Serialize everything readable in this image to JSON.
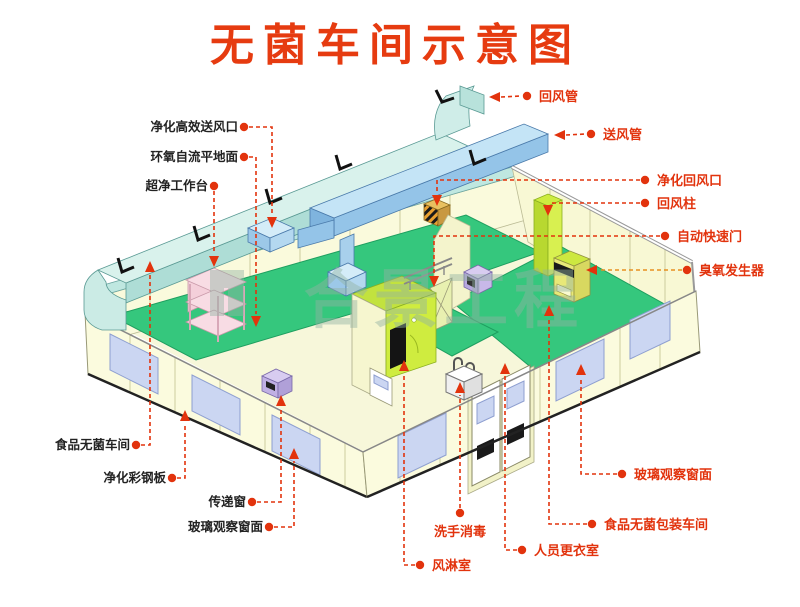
{
  "title": "无菌车间示意图",
  "watermark": {
    "text": "合景工程"
  },
  "labels": {
    "hepa_supply_vent": {
      "text": "净化高效送风口"
    },
    "epoxy_floor": {
      "text": "环氧自流平地面"
    },
    "clean_workbench": {
      "text": "超净工作台"
    },
    "food_sterile_workshop": {
      "text": "食品无菌车间"
    },
    "purification_steel_panel": {
      "text": "净化彩钢板"
    },
    "transfer_window": {
      "text": "传递窗"
    },
    "glass_window_left": {
      "text": "玻璃观察窗面"
    },
    "return_duct": {
      "text": "回风管"
    },
    "supply_duct": {
      "text": "送风管"
    },
    "purification_return_vent": {
      "text": "净化回风口"
    },
    "return_air_column": {
      "text": "回风柱"
    },
    "automatic_quick_door": {
      "text": "自动快速门"
    },
    "ozone_generator": {
      "text": "臭氧发生器"
    },
    "glass_window_right": {
      "text": "玻璃观察窗面"
    },
    "food_sterile_packaging_workshop": {
      "text": "食品无菌包装车间"
    },
    "personnel_changing_room": {
      "text": "人员更衣室"
    },
    "hand_wash_disinfection": {
      "text": "洗手消毒"
    },
    "air_shower_room": {
      "text": "风淋室"
    }
  },
  "colors": {
    "title_red": "#e63b10",
    "label_red": "#e2330d",
    "floor_green": "#35c77d",
    "duct_cyan": "#d9f2ec",
    "supply_blue": "#c4e4f6",
    "lime": "#cdec3f",
    "wall_ivory": "#fbfbde",
    "watermark_gray_green": "#93b3a3"
  }
}
